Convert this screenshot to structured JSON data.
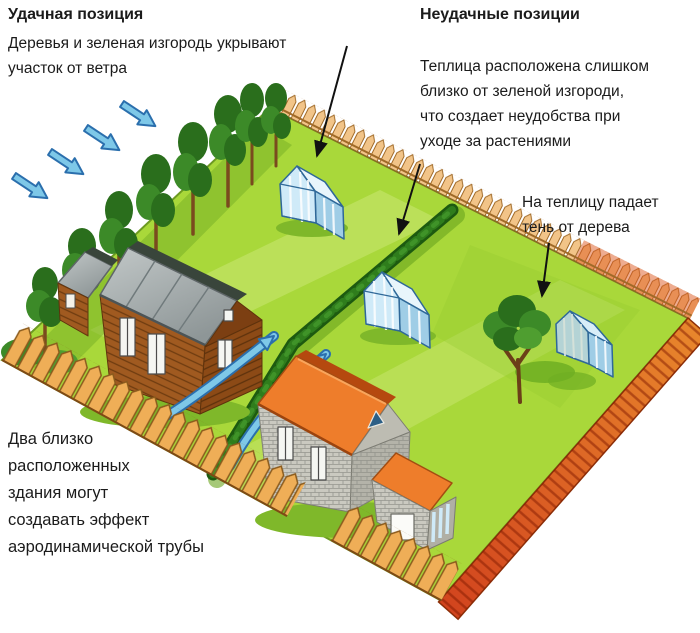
{
  "annotations": {
    "good": {
      "title": "Удачная позиция",
      "body": "Деревья и зеленая изгородь укрывают\nучасток от ветра"
    },
    "bad": {
      "title": "Неудачные позиции",
      "body": "Теплица расположена слишком\nблизко от зеленой изгороди,\nчто создает неудобства при\nуходе за растениями"
    },
    "shade": {
      "body": "На теплицу падает\nтень от дерева"
    },
    "tunnel": {
      "body": "Два близко\nрасположенных\nздания могут\nсоздавать эффект\nаэродинамической трубы"
    }
  },
  "scene": {
    "elements": [
      "garden-plot",
      "picket-fence",
      "windbreak-trees",
      "wind-arrows",
      "green-hedge",
      "wooden-house",
      "stone-house",
      "house-annex",
      "greenhouse-good",
      "greenhouse-near-hedge",
      "greenhouse-shaded",
      "shade-tree",
      "tree-shadow",
      "wind-tunnel-arrows",
      "annotation-arrows"
    ],
    "colors": {
      "lawn": "#a9d83a",
      "lawn_light": "#ddf094",
      "lawn_shade": "#76ad24",
      "tree_dark": "#2a6e1c",
      "tree_mid": "#3c8a28",
      "tree_light": "#4f9e30",
      "trunk": "#7a4a1e",
      "hedge": "#1d5a10",
      "fence": "#f2c488",
      "fence_dark": "#a06a28",
      "fence_orange": "#efae57",
      "fence_red": "#d2441e",
      "wind_arrow": "#7ec8e8",
      "wind_arrow_edge": "#2b6fad",
      "greenhouse": "#cfeaf8",
      "greenhouse_shade": "#9fcde6",
      "greenhouse_frame": "#2f6898",
      "wood_wall": "#a05a20",
      "wood_wall_dark": "#7c3f12",
      "wood_roof": "#a7adad",
      "stone_wall": "#cac9c0",
      "stone_roof": "#ee7d2b",
      "annotation": "#111111"
    }
  }
}
